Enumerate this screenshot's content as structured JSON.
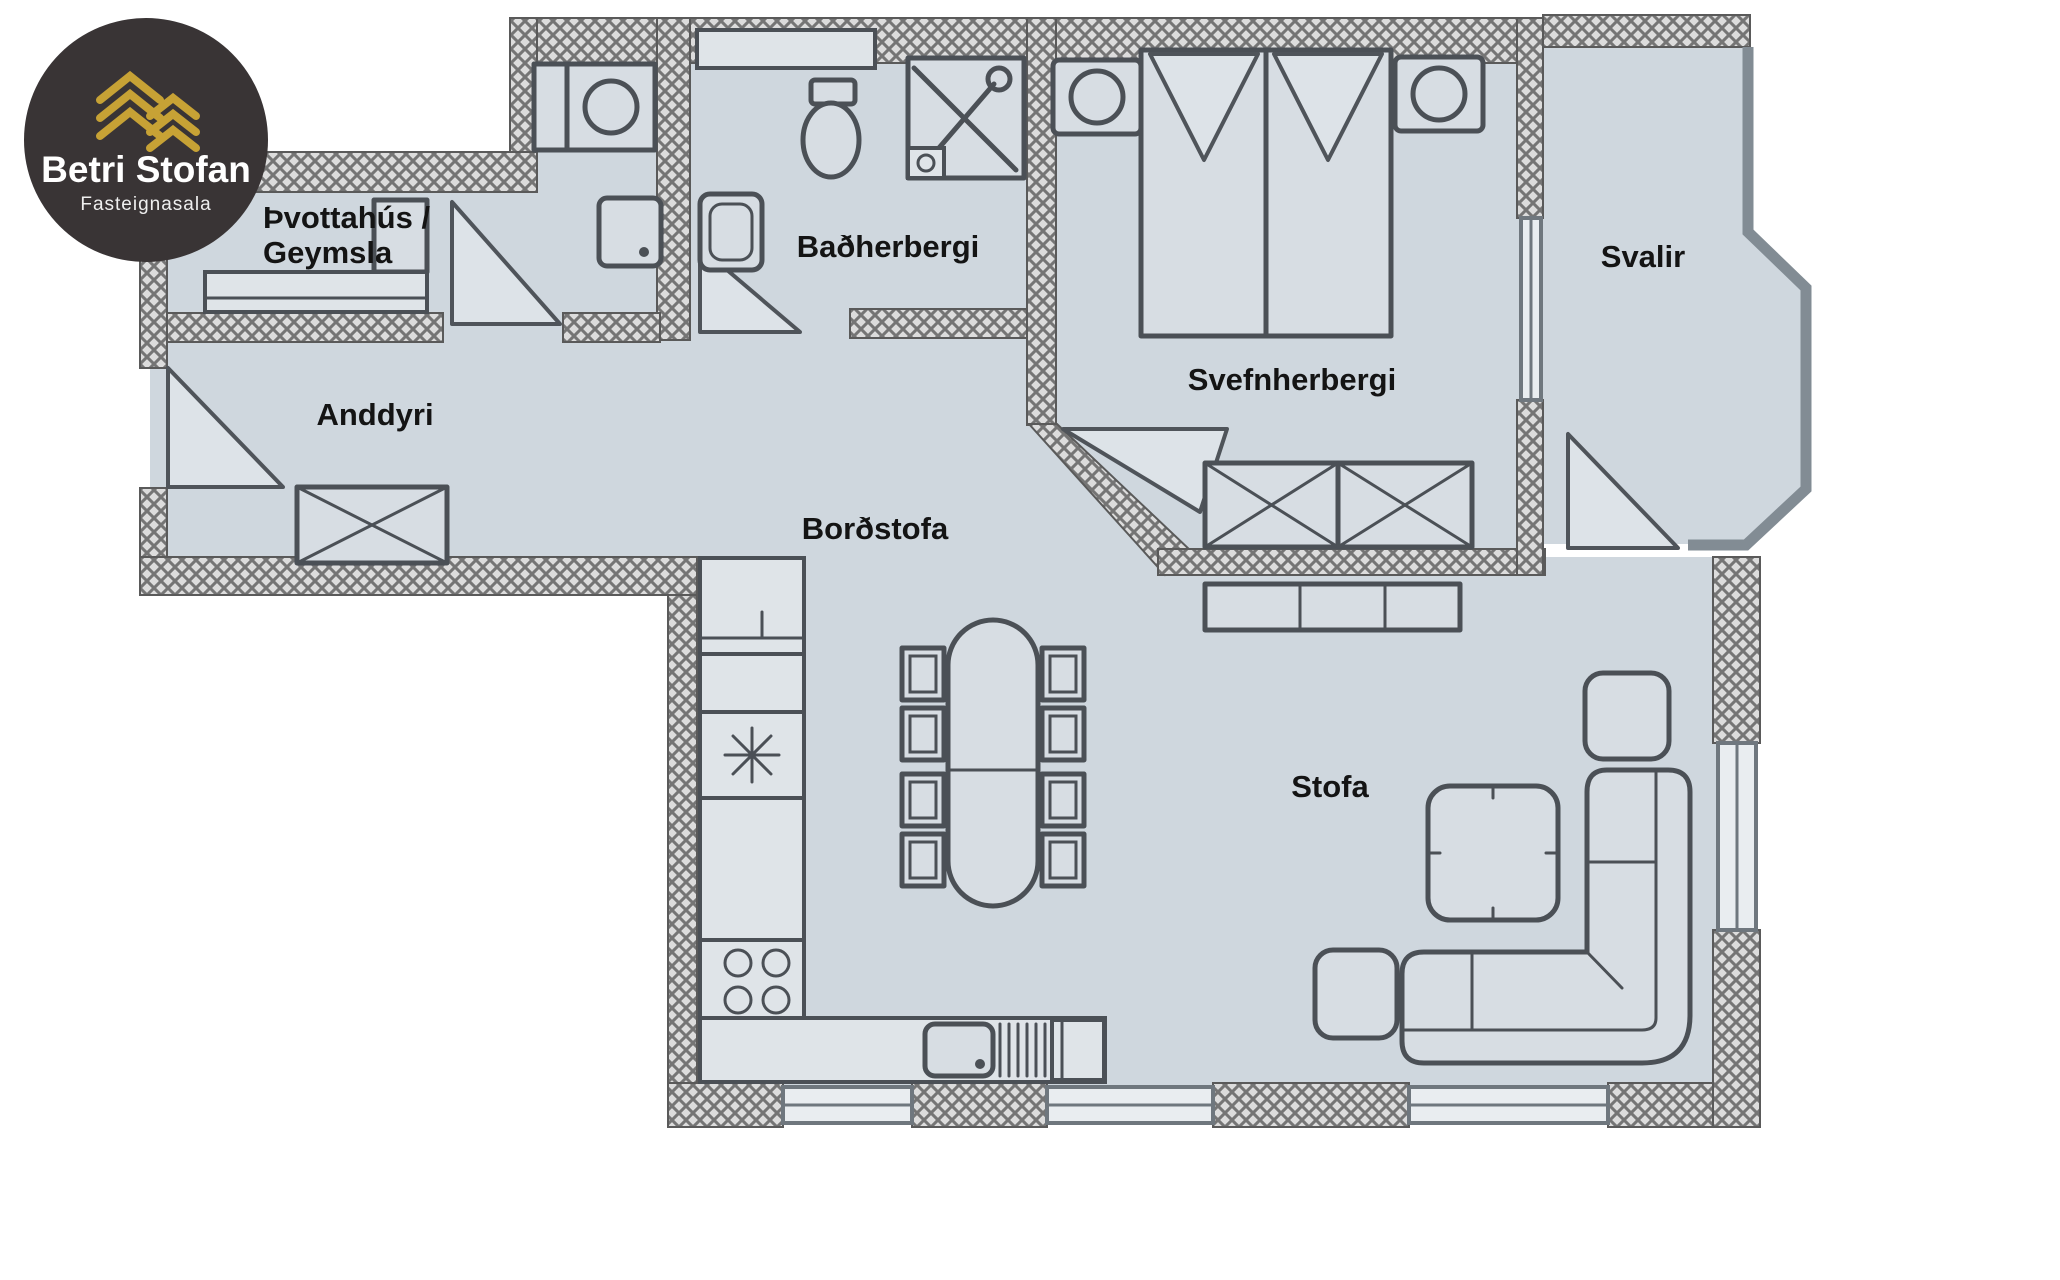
{
  "brand": {
    "name": "Betri Stofan",
    "tagline": "Fasteignasala"
  },
  "rooms": {
    "laundry_line1": "Þvottahús /",
    "laundry_line2": "Geymsla",
    "bathroom": "Baðherbergi",
    "bedroom": "Svefnherbergi",
    "balcony": "Svalir",
    "entry": "Anddyri",
    "dining": "Borðstofa",
    "living": "Stofa"
  },
  "colors": {
    "floor": "#cfd7de",
    "wall_hatch_dark": "#757575",
    "wall_hatch_light": "#dcdcdc",
    "outline": "#4b5056",
    "label": "#141414",
    "logo_background": "#393435",
    "logo_gold": "#c7a235",
    "logo_text": "#ffffff"
  }
}
